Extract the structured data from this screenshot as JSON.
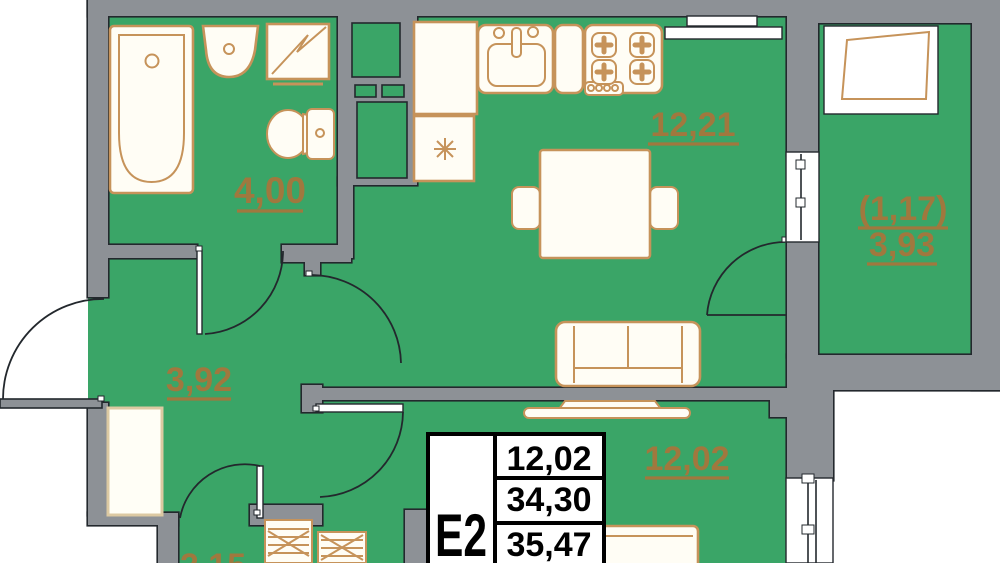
{
  "plan": {
    "unit": {
      "label": "E2",
      "rows": [
        "12,02",
        "34,30",
        "35,47"
      ]
    },
    "rooms": {
      "bathroom": "4,00",
      "kitchen_living": "12,21",
      "balcony_reduced": "(1,17)",
      "balcony": "3,93",
      "hall": "3,92",
      "bedroom": "12,02",
      "storage": "2,15"
    },
    "colors": {
      "floor": "#3aa567",
      "wall_fill": "#8d9196",
      "outline": "#23282d",
      "furniture": "#c6935a",
      "label": "#a0783e",
      "table_border": "#000000",
      "table_text": "#000000",
      "fixture_fill": "#fffdf5"
    }
  }
}
